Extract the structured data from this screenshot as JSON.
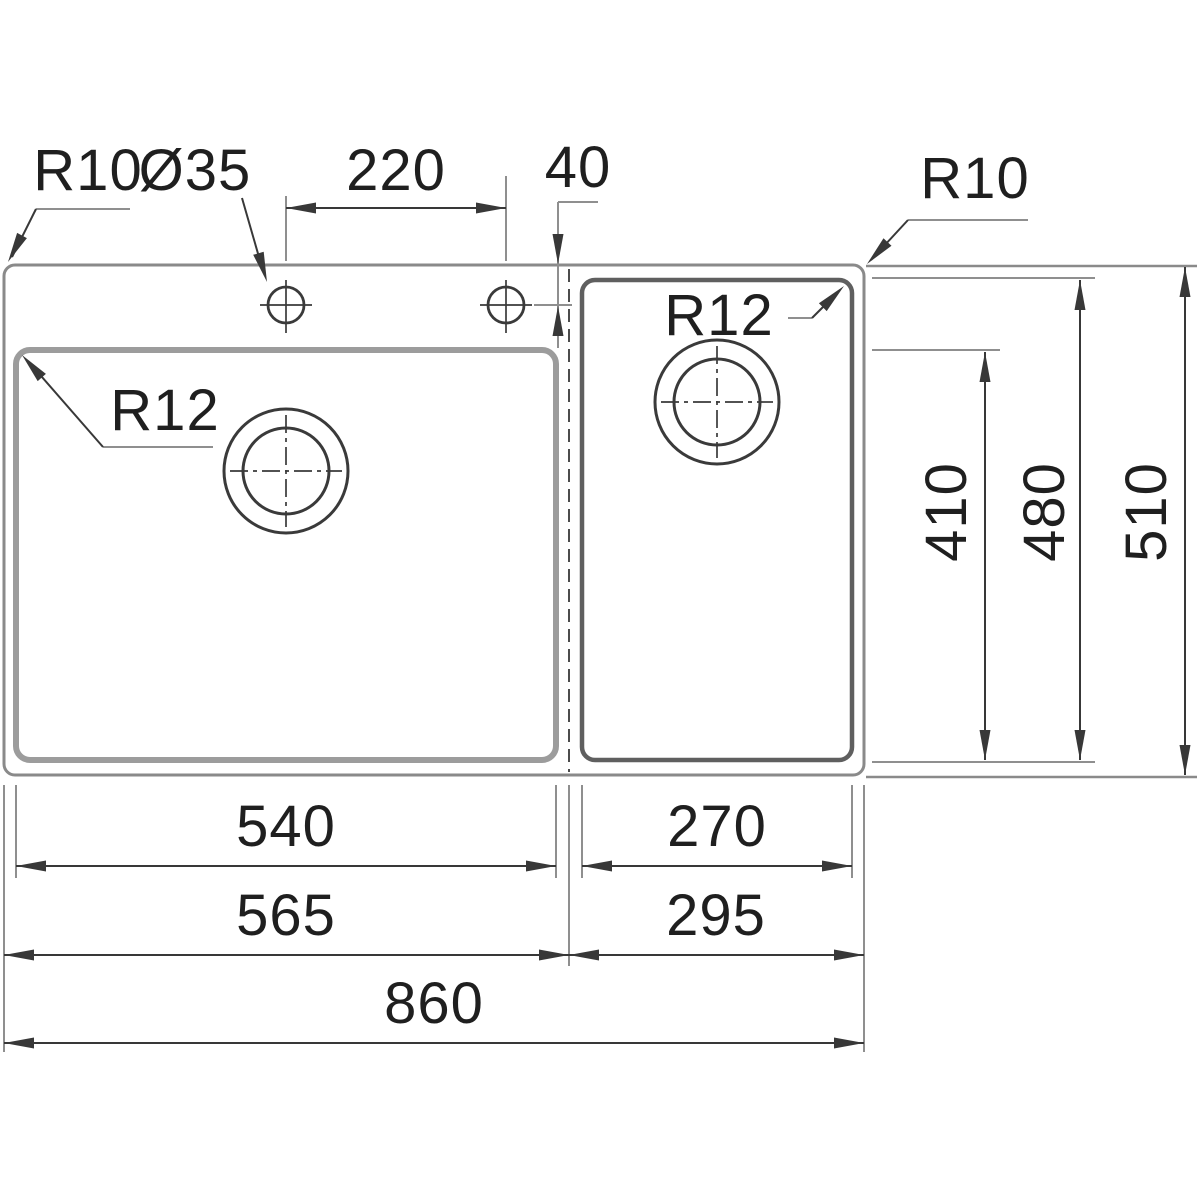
{
  "drawing": {
    "kind": "sink-technical-drawing-top-view",
    "labels": {
      "radius_top_left": "R10",
      "tap_hole_diameter": "Ø35",
      "tap_hole_spacing": "220",
      "tap_hole_offset": "40",
      "radius_top_right": "R10",
      "radius_main_bowl": "R12",
      "radius_small_bowl": "R12",
      "main_bowl_depth": "410",
      "small_bowl_depth": "480",
      "overall_depth": "510",
      "main_bowl_width": "540",
      "small_bowl_width": "270",
      "main_section_width": "565",
      "small_section_width": "295",
      "overall_width": "860"
    },
    "dimensions_mm": {
      "overall_width": 860,
      "overall_depth": 510,
      "main_section_width": 565,
      "small_section_width": 295,
      "main_bowl_width": 540,
      "main_bowl_depth": 410,
      "small_bowl_width": 270,
      "small_bowl_depth": 480,
      "tap_hole_spacing": 220,
      "tap_hole_offset_from_edge": 40,
      "tap_hole_diameter": 35,
      "outer_corner_radius": 10,
      "bowl_corner_radius": 12
    },
    "colors": {
      "background": "#ffffff",
      "ink": "#1f1f1f",
      "dim_line": "#383838",
      "ext_line": "#8f8f8f",
      "sink_outline": "#8a8a8a",
      "bowl_left_outline": "#9c9c9c",
      "bowl_right_outline": "#5f5f5f",
      "hidden_line": "#4c4c4c",
      "feature_line": "#3a3a3a"
    }
  }
}
